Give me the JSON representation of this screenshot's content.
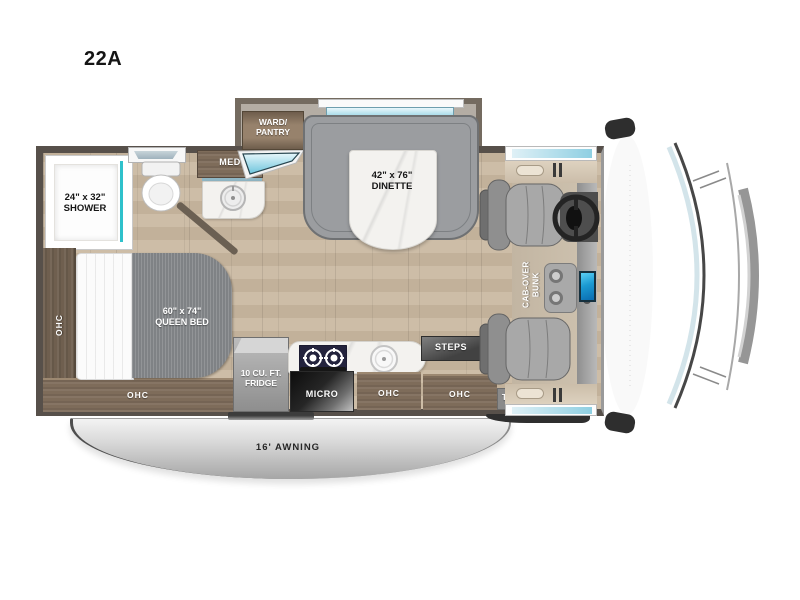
{
  "model_label": "22A",
  "labels": {
    "shower_size": "24\" x 32\"",
    "shower_name": "SHOWER",
    "ward_line1": "WARD/",
    "ward_line2": "PANTRY",
    "med": "MED",
    "dinette_size": "42\" x 76\"",
    "dinette_name": "DINETTE",
    "bed_size": "60\" x 74\"",
    "bed_name": "QUEEN BED",
    "ohc_side": "OHC",
    "ohc_bed_foot": "OHC",
    "ohc_kitchen": "OHC",
    "ohc_entry": "OHC",
    "fridge_line1": "10 CU. FT.",
    "fridge_line2": "FRIDGE",
    "micro": "MICRO",
    "steps": "STEPS",
    "bunk_line1": "CAB-OVER",
    "bunk_line2": "BUNK",
    "tv": "TV",
    "awning": "16' AWNING"
  },
  "colors": {
    "wall": "#57504a",
    "accent_teal": "#2fc1cb",
    "window_glass": "#8fd2e4",
    "wood_floor": "#c9b8a2",
    "cabinet_wood": "#7e6c5a",
    "bench_gray": "#9b9da0",
    "screen_blue": "#1b9ad2",
    "awning_silver": "#c9c9c9"
  }
}
